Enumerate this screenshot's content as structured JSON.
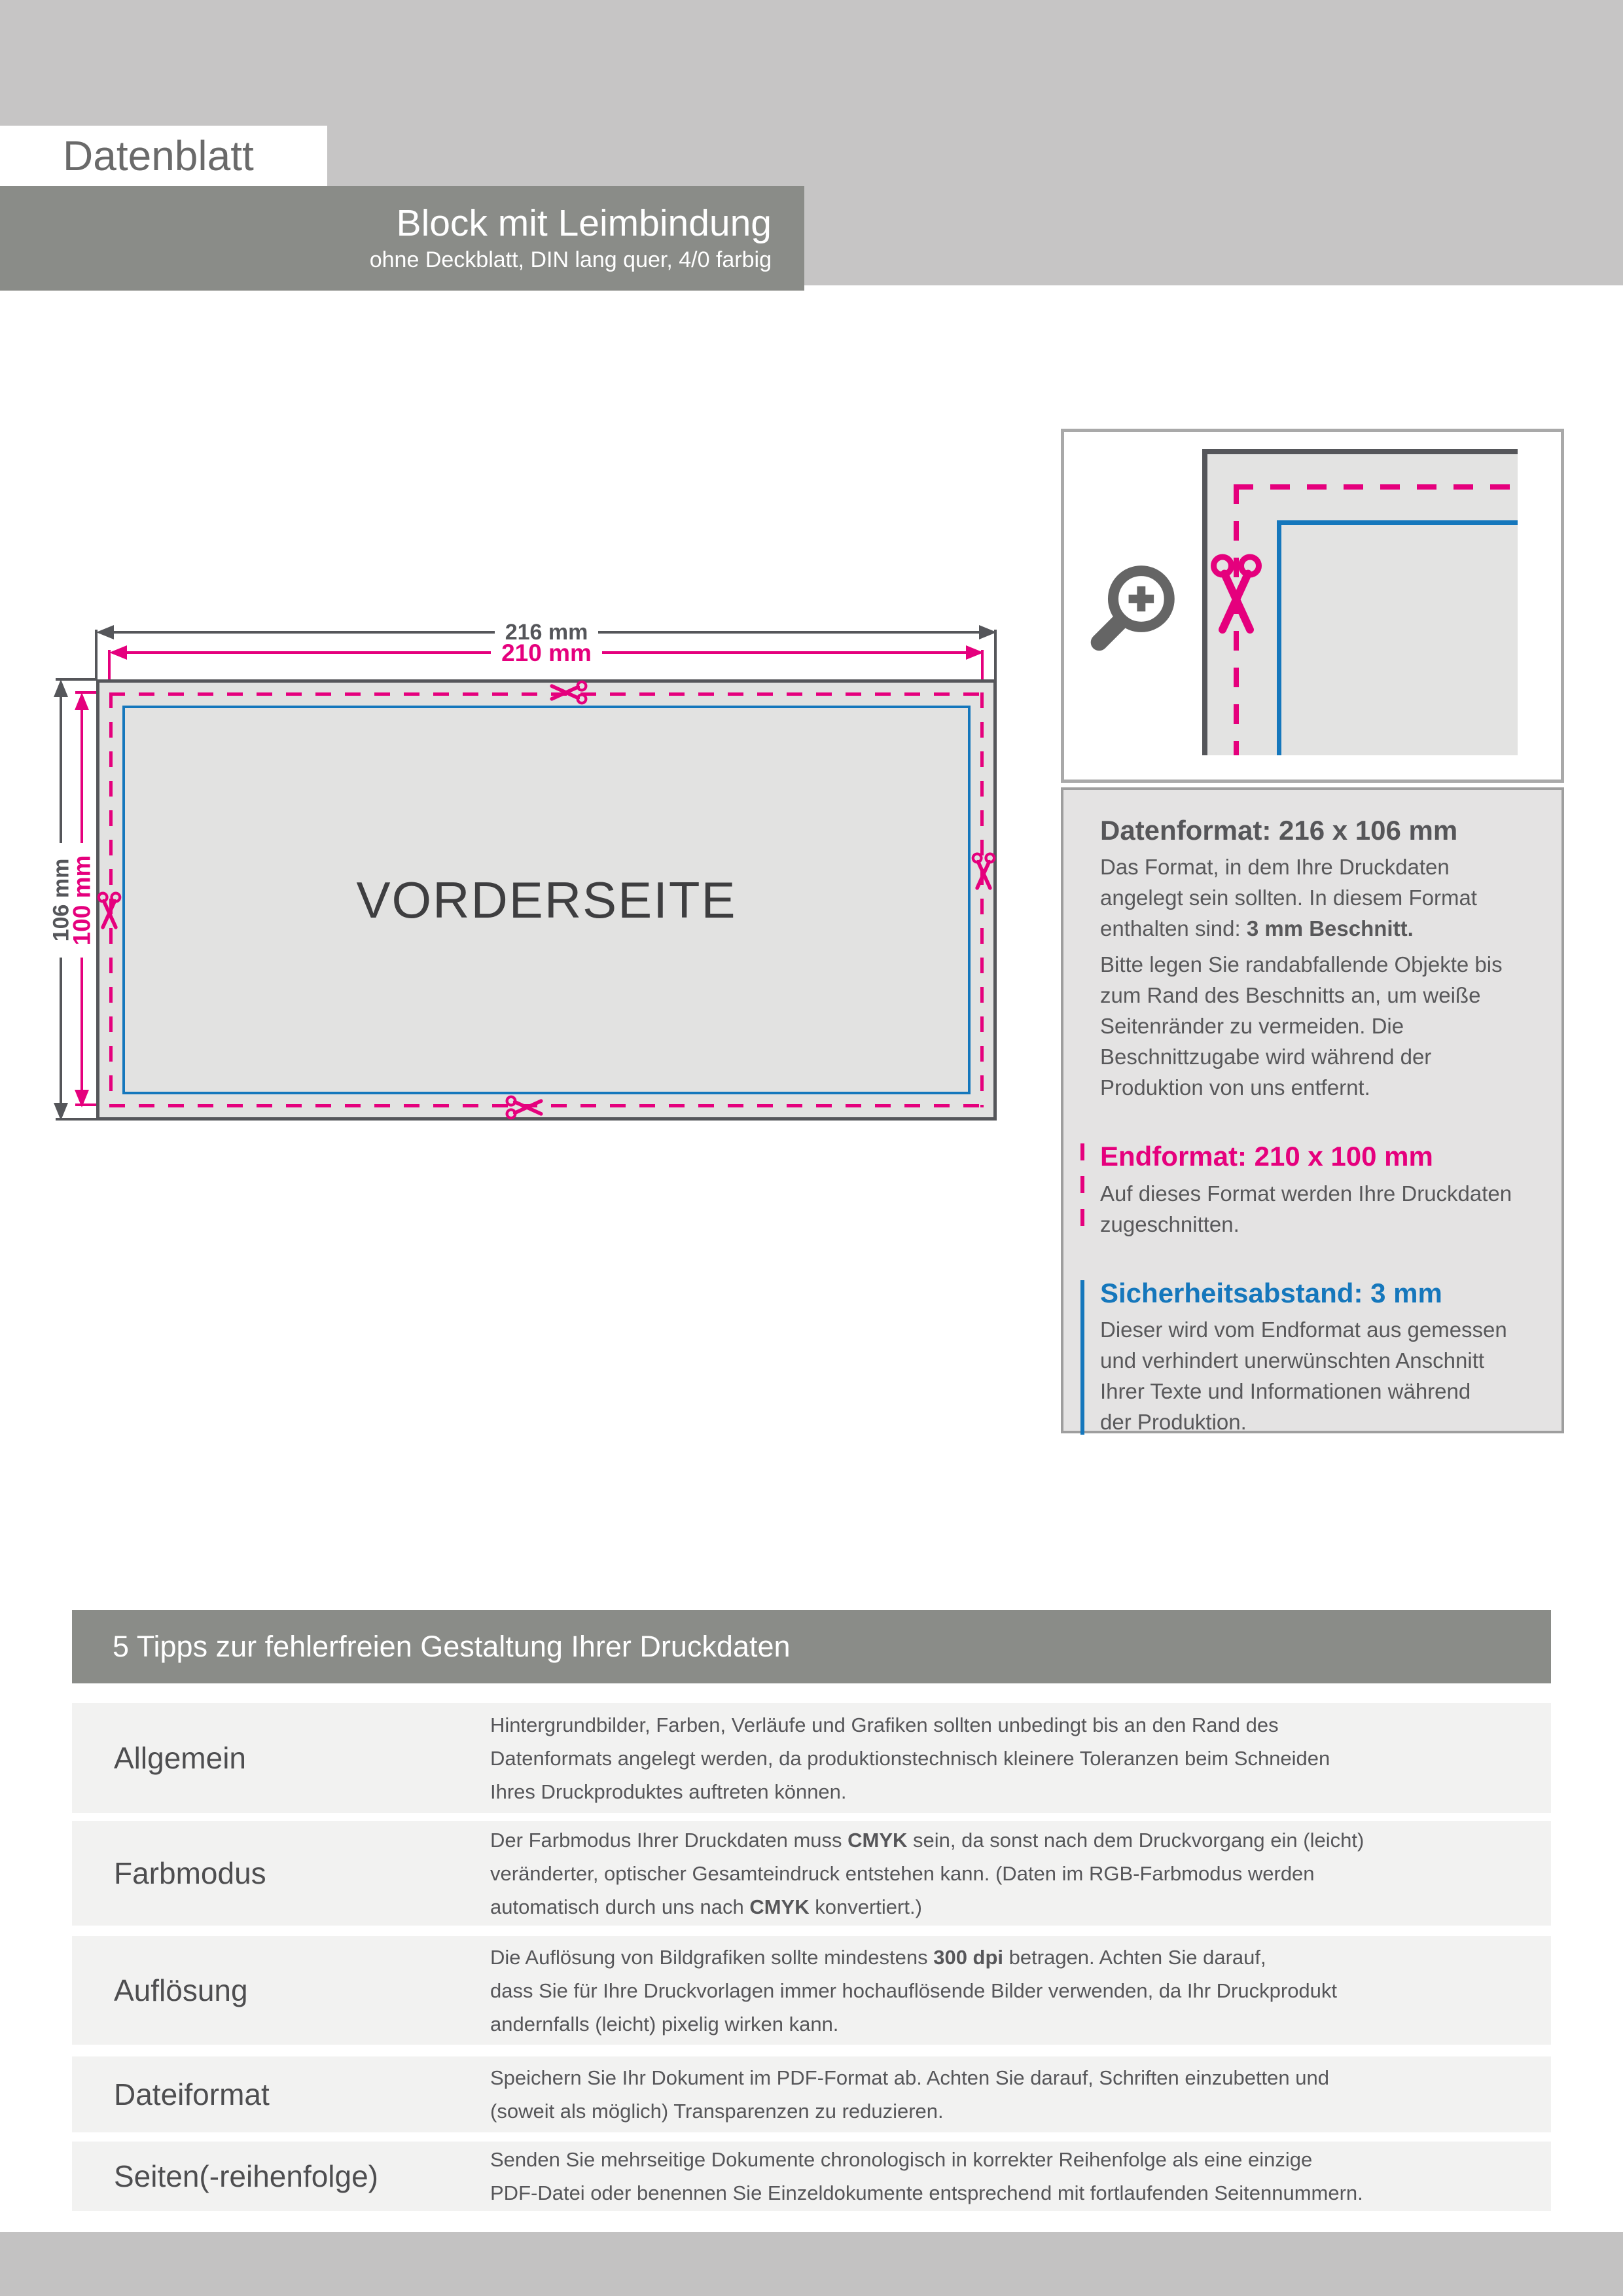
{
  "page": {
    "eyebrow": "Datenblatt",
    "title": "Block mit Leimbindung",
    "subtitle": "ohne Deckblatt, DIN lang quer, 4/0 farbig"
  },
  "diagram": {
    "dim_width_outer": "216 mm",
    "dim_width_final": "210 mm",
    "dim_height_outer": "106 mm",
    "dim_height_final": "100 mm",
    "panel_label": "VORDERSEITE"
  },
  "legend": {
    "dataformat": {
      "heading": "Datenformat: 216 x 106 mm",
      "body1": [
        {
          "t": "Das Format, in dem Ihre Druckdaten\nangelegt sein sollten. In diesem Format\nenthalten sind: "
        },
        {
          "t": "3 mm Beschnitt.",
          "b": true
        }
      ],
      "body2": [
        {
          "t": "Bitte legen Sie randabfallende Objekte bis\nzum Rand des Beschnitts an, um weiße\nSeitenränder zu vermeiden. Die\nBeschnittzugabe wird während der\nProduktion von uns entfernt."
        }
      ]
    },
    "endformat": {
      "heading": "Endformat: 210 x 100 mm",
      "body": [
        {
          "t": "Auf dieses Format werden Ihre Druckdaten\nzugeschnitten."
        }
      ]
    },
    "safety": {
      "heading": "Sicherheitsabstand: 3 mm",
      "body": [
        {
          "t": "Dieser wird vom Endformat aus gemessen\nund verhindert unerwünschten Anschnitt\nIhrer Texte und Informationen während\nder Produktion."
        }
      ]
    }
  },
  "tips": {
    "heading": "5 Tipps zur fehlerfreien Gestaltung Ihrer Druckdaten",
    "rows": [
      {
        "label": "Allgemein",
        "text": [
          {
            "t": "Hintergrundbilder, Farben, Verläufe und Grafiken sollten unbedingt bis an den Rand des\nDatenformats angelegt werden, da produktionstechnisch kleinere Toleranzen beim Schneiden\nIhres Druckproduktes auftreten können."
          }
        ]
      },
      {
        "label": "Farbmodus",
        "text": [
          {
            "t": "Der Farbmodus Ihrer Druckdaten muss "
          },
          {
            "t": "CMYK",
            "b": true
          },
          {
            "t": " sein, da sonst nach dem Druckvorgang ein (leicht)\nveränderter, optischer Gesamteindruck entstehen kann. (Daten im RGB-Farbmodus werden\nautomatisch durch uns nach "
          },
          {
            "t": "CMYK",
            "b": true
          },
          {
            "t": " konvertiert.)"
          }
        ]
      },
      {
        "label": "Auflösung",
        "text": [
          {
            "t": "Die Auflösung von Bildgrafiken sollte mindestens "
          },
          {
            "t": "300 dpi",
            "b": true
          },
          {
            "t": " betragen. Achten Sie darauf,\ndass Sie für Ihre Druckvorlagen immer hochauflösende Bilder verwenden, da Ihr Druckprodukt\nandernfalls (leicht) pixelig wirken kann."
          }
        ]
      },
      {
        "label": "Dateiformat",
        "text": [
          {
            "t": "Speichern Sie Ihr Dokument im PDF-Format ab. Achten Sie darauf, Schriften einzubetten und\n(soweit als möglich) Transparenzen zu reduzieren."
          }
        ]
      },
      {
        "label": "Seiten(-reihenfolge)",
        "text": [
          {
            "t": "Senden Sie mehrseitige Dokumente chronologisch in korrekter Reihenfolge als eine einzige\nPDF-Datei oder benennen Sie Einzeldokumente entsprechend mit fortlaufenden Seitennummern."
          }
        ]
      }
    ]
  },
  "colors": {
    "magenta": "#e5007d",
    "blue": "#1577bc",
    "dark": "#8a8c88",
    "light": "#c6c5c5",
    "ink": "#55565a"
  }
}
